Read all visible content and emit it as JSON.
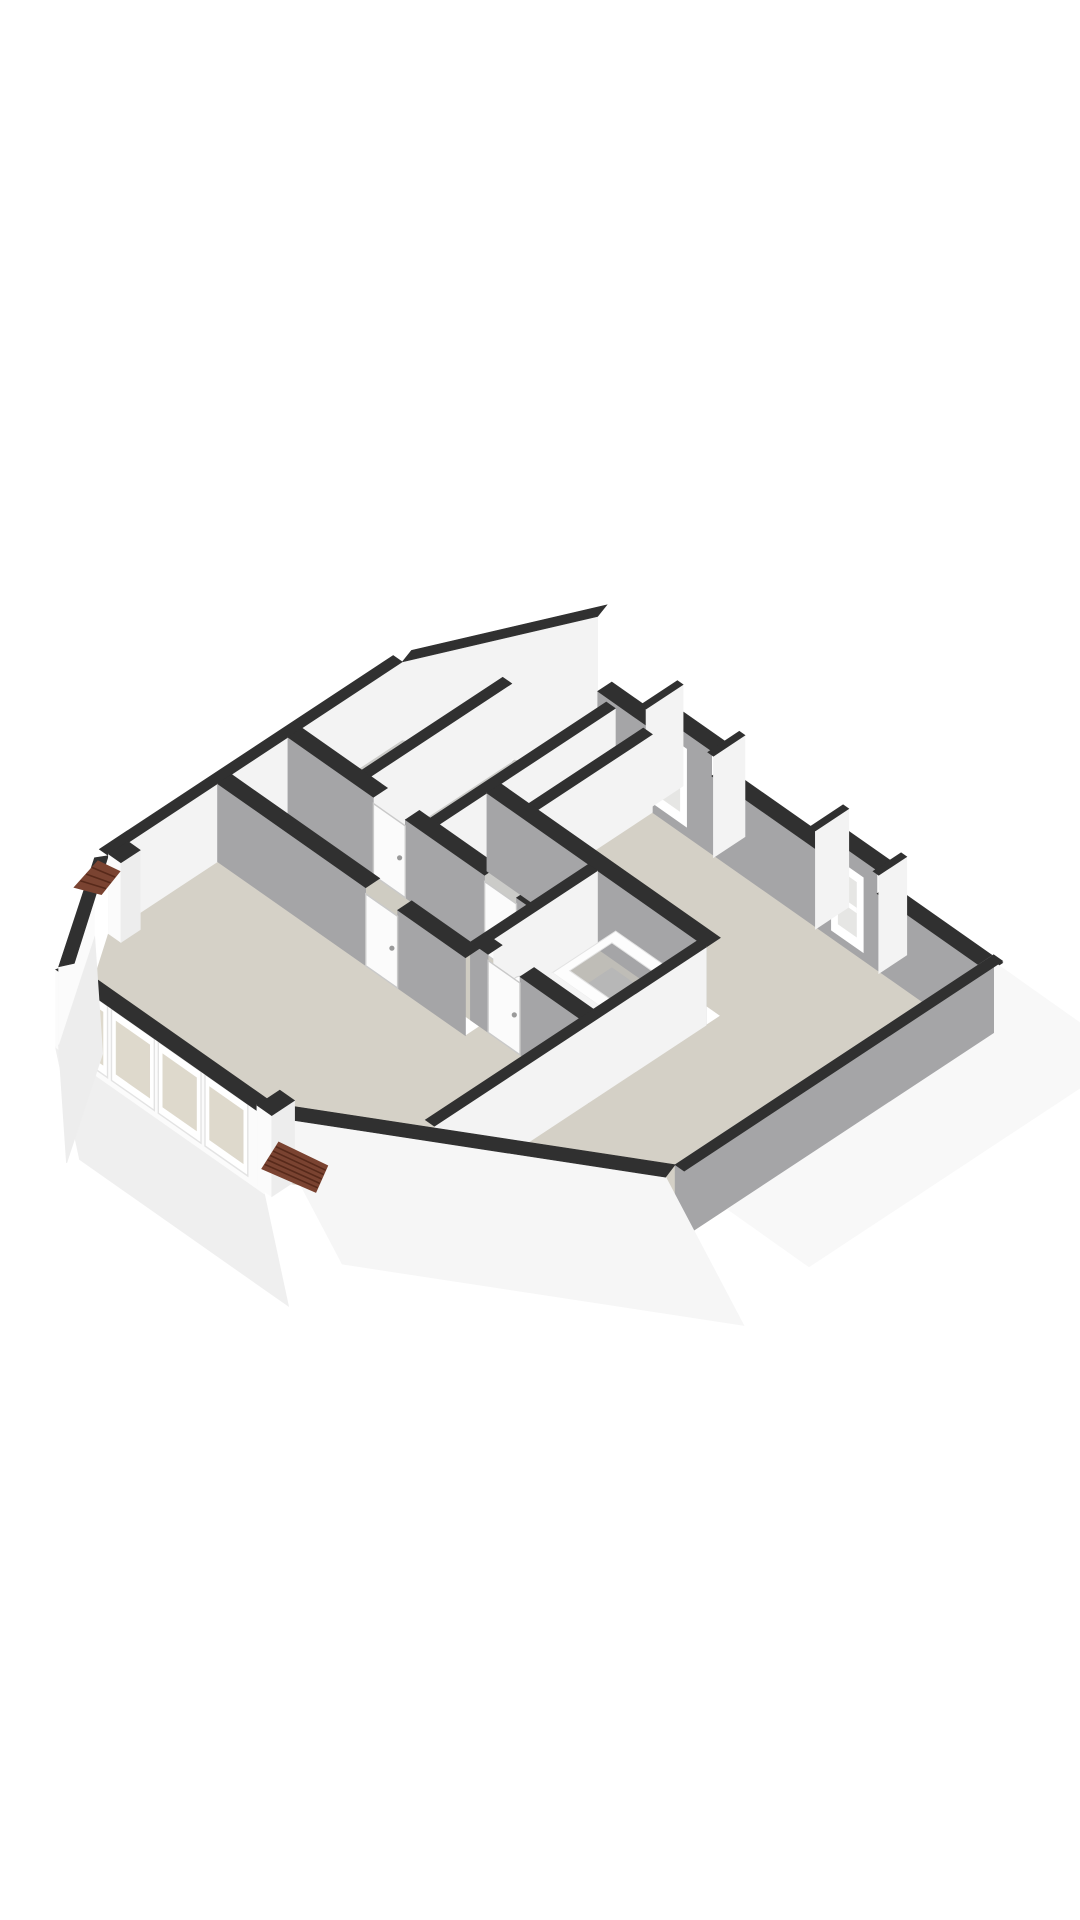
{
  "page": {
    "background": "#ffffff",
    "label": "3d-floorplan-render"
  },
  "scene": {
    "projection": {
      "ox": 478,
      "oy": 690,
      "ux": 57,
      "uy": 40,
      "vx": -88,
      "vy": 58,
      "hz": 78
    },
    "palette": {
      "cap": "#303030",
      "grayFace": "#a5a5a7",
      "grayFace2": "#9c9c9e",
      "white": "#f3f3f3",
      "whiteBright": "#fbfbfb",
      "frame": "#ffffff",
      "floorLiving": "#d5d1c7",
      "floorBed": "#d4d0c6",
      "floorHall": "#cfccc2",
      "floorSmall": "#cbcbc8",
      "floorBath": "#bfbdb7",
      "glassS": "#ded9cc",
      "glassN": "#e6e6e4",
      "roof": "#7a4331",
      "roofLine": "#57291a",
      "skirtS": "#efefef",
      "skirtE": "#f8f8f8",
      "doorFill": "#fbfbfb",
      "doorStroke": "#c9c9c9",
      "tubFloor": "#b7b7b7",
      "tubStroke": "#e3e3e3"
    },
    "elements": [
      {
        "name": "floor-room-topleft-a",
        "type": "floor",
        "pts": [
          [
            0,
            0.86
          ],
          [
            1.05,
            0.43
          ],
          [
            1.05,
            2.0
          ],
          [
            0,
            2.0
          ]
        ],
        "fill": "floorSmall"
      },
      {
        "name": "floor-room-topleft-b",
        "type": "floor",
        "pts": [
          [
            1.21,
            0.36
          ],
          [
            2.41,
            0
          ],
          [
            2.41,
            2.0
          ],
          [
            1.21,
            2.0
          ]
        ],
        "fill": "floorSmall"
      },
      {
        "name": "floor-nook",
        "type": "floor",
        "pts": [
          [
            2.41,
            0
          ],
          [
            2.9,
            0
          ],
          [
            2.9,
            1.3
          ],
          [
            2.41,
            1.3
          ]
        ],
        "fill": "floorBed"
      },
      {
        "name": "floor-bedroom",
        "type": "floor",
        "pts": [
          [
            3.06,
            0
          ],
          [
            8.8,
            0
          ],
          [
            8.8,
            3.46
          ],
          [
            6.26,
            4.55
          ],
          [
            6.26,
            1.3
          ],
          [
            3.06,
            1.3
          ]
        ],
        "fill": "floorBed"
      },
      {
        "name": "floor-closet",
        "type": "floor",
        "pts": [
          [
            2.41,
            1.46
          ],
          [
            4.19,
            1.46
          ],
          [
            4.19,
            2.0
          ],
          [
            2.41,
            2.0
          ]
        ],
        "fill": "floorSmall"
      },
      {
        "name": "floor-hallway",
        "type": "floor",
        "pts": [
          [
            0,
            2.16
          ],
          [
            4.35,
            2.16
          ],
          [
            4.35,
            2.8
          ],
          [
            0,
            2.8
          ]
        ],
        "fill": "floorHall"
      },
      {
        "name": "floor-bathroom",
        "type": "floor",
        "pts": [
          [
            4.35,
            1.46
          ],
          [
            6.1,
            1.46
          ],
          [
            6.1,
            2.64
          ],
          [
            4.35,
            2.64
          ]
        ],
        "fill": "floorBath"
      },
      {
        "name": "floor-livingroom",
        "type": "floor",
        "pts": [
          [
            0,
            2.96
          ],
          [
            4.35,
            2.96
          ],
          [
            4.35,
            2.8
          ],
          [
            6.1,
            2.8
          ],
          [
            6.1,
            4.62
          ],
          [
            4.6,
            5.3
          ],
          [
            1.1,
            5.3
          ],
          [
            0,
            4.2
          ]
        ],
        "fill": "floorLiving"
      },
      {
        "name": "gable-wall-face",
        "type": "poly3",
        "pts": [
          [
            0,
            0.86,
            0
          ],
          [
            2.1,
            0,
            0
          ],
          [
            2.1,
            0,
            2.02
          ],
          [
            0,
            0.86,
            1.0
          ]
        ],
        "fill": "white"
      },
      {
        "name": "gable-wall-cap",
        "type": "poly3",
        "pts": [
          [
            2.1,
            0,
            2.02
          ],
          [
            0,
            0.86,
            1.0
          ],
          [
            -0.07,
            0.71,
            1.0
          ],
          [
            2.03,
            -0.15,
            2.02
          ]
        ],
        "fill": "cap"
      },
      {
        "name": "north-wall-1",
        "type": "uwall",
        "x1": 2.1,
        "x2": 2.95,
        "y": -0.16,
        "h": 1.06,
        "face": "grayFace"
      },
      {
        "name": "north-wall-dormer-1",
        "type": "uwall",
        "x1": 2.95,
        "x2": 4.1,
        "y": -0.16,
        "h": 1.32,
        "face": "grayFace",
        "wins": [
          {
            "u1": 3.02,
            "u2": 3.66,
            "z1": 0.12,
            "z2": 1.12,
            "fill": "frame"
          },
          {
            "u1": 3.14,
            "u2": 3.54,
            "z1": 0.26,
            "z2": 1.0,
            "fill": "glassN"
          },
          {
            "u1": 3.14,
            "u2": 3.54,
            "z1": 0.6,
            "z2": 0.66,
            "fill": "frame"
          }
        ]
      },
      {
        "name": "north-wall-2",
        "type": "uwall",
        "x1": 4.1,
        "x2": 5.92,
        "y": -0.16,
        "h": 1.0,
        "face": "grayFace"
      },
      {
        "name": "north-wall-dormer-2",
        "type": "uwall",
        "x1": 5.92,
        "x2": 7.0,
        "y": -0.16,
        "h": 1.28,
        "face": "grayFace",
        "wins": [
          {
            "u1": 6.2,
            "u2": 6.76,
            "z1": 0.1,
            "z2": 1.06,
            "fill": "frame"
          },
          {
            "u1": 6.32,
            "u2": 6.64,
            "z1": 0.24,
            "z2": 0.94,
            "fill": "glassN"
          },
          {
            "u1": 6.32,
            "u2": 6.64,
            "z1": 0.55,
            "z2": 0.61,
            "fill": "frame"
          }
        ]
      },
      {
        "name": "north-wall-3",
        "type": "uwall",
        "x1": 7.0,
        "x2": 8.96,
        "y": -0.16,
        "h": 0.98,
        "face": "grayFace"
      },
      {
        "name": "dormer-1-cheek-left",
        "type": "vwall",
        "x": 2.88,
        "t": 0.1,
        "y1": -0.4,
        "y2": 0.02,
        "h": 1.3,
        "face": "white"
      },
      {
        "name": "dormer-1-cheek-right",
        "type": "vwall",
        "x": 4.06,
        "t": 0.1,
        "y1": -0.34,
        "y2": 0.02,
        "h": 1.3,
        "face": "white"
      },
      {
        "name": "dormer-2-cheek-left",
        "type": "vwall",
        "x": 5.85,
        "t": 0.1,
        "y1": -0.36,
        "y2": 0.02,
        "h": 1.26,
        "face": "white"
      },
      {
        "name": "dormer-2-cheek-right",
        "type": "vwall",
        "x": 6.96,
        "t": 0.1,
        "y1": -0.3,
        "y2": 0.02,
        "h": 1.26,
        "face": "white"
      },
      {
        "name": "west-wall",
        "type": "vwall",
        "x": -0.16,
        "t": 0.16,
        "y1": 0.86,
        "y2": 4.2,
        "h": 1.0,
        "face": "white"
      },
      {
        "name": "closet-block-east-wall",
        "type": "vwall",
        "x": 2.25,
        "t": 0.16,
        "y1": 0,
        "y2": 2.0,
        "h": 1,
        "face": "white"
      },
      {
        "name": "closet-block-divider-wall",
        "type": "vwall",
        "x": 1.05,
        "t": 0.16,
        "y1": 0.4,
        "y2": 2.0,
        "h": 1,
        "face": "white"
      },
      {
        "name": "closet-block-south-wall",
        "type": "uwall",
        "x1": 0,
        "x2": 4.35,
        "y": 2.0,
        "h": 1,
        "face": "grayFace",
        "gaps": [
          [
            1.5,
            2.06
          ],
          [
            3.45,
            4.01
          ]
        ]
      },
      {
        "name": "door-topleft-room",
        "type": "frect",
        "plane": "y",
        "at": 2.16,
        "u1": 1.5,
        "u2": 2.06,
        "z1": 0,
        "z2": 0.92,
        "fill": "doorFill",
        "stroke": "doorStroke",
        "handle": true
      },
      {
        "name": "door-closet",
        "type": "frect",
        "plane": "y",
        "at": 2.16,
        "u1": 3.45,
        "u2": 4.01,
        "z1": 0,
        "z2": 0.92,
        "fill": "doorFill",
        "stroke": "doorStroke",
        "handle": true
      },
      {
        "name": "nook-east-wall",
        "type": "vwall",
        "x": 2.9,
        "t": 0.16,
        "y1": 0,
        "y2": 1.3,
        "h": 1,
        "face": "white"
      },
      {
        "name": "bedroom-south-wall",
        "type": "uwall",
        "x1": 2.41,
        "x2": 6.26,
        "y": 1.3,
        "h": 1,
        "face": "grayFace"
      },
      {
        "name": "bathroom-west-wall",
        "type": "vwall",
        "x": 4.19,
        "t": 0.16,
        "y1": 1.46,
        "y2": 2.64,
        "h": 1,
        "face": "white"
      },
      {
        "name": "bathtub",
        "type": "ring",
        "outer": [
          4.7,
          1.48,
          6.0,
          2.2
        ],
        "inner": [
          4.82,
          1.6,
          5.88,
          2.08
        ],
        "ztop": 0.42,
        "zfloor": 0.1
      },
      {
        "name": "toilet-bowl",
        "type": "ellipse",
        "c": [
          4.52,
          2.38,
          0.3
        ],
        "rx": 14,
        "ry": 9,
        "fill": "#fdfdfd",
        "stroke": "#d8d8d8"
      },
      {
        "name": "toilet-tank",
        "type": "box",
        "x1": 4.38,
        "y1": 2.48,
        "x2": 4.64,
        "y2": 2.62,
        "h": 0.4,
        "top": "#f6f6f6",
        "south": "#ececec",
        "east": "#e6e6e6"
      },
      {
        "name": "bathroom-south-wall",
        "type": "uwall",
        "x1": 4.19,
        "x2": 6.26,
        "y": 2.64,
        "h": 1,
        "face": "grayFace",
        "gaps": [
          [
            4.5,
            5.06
          ]
        ]
      },
      {
        "name": "door-bathroom",
        "type": "frect",
        "plane": "y",
        "at": 2.8,
        "u1": 4.5,
        "u2": 5.06,
        "z1": 0,
        "z2": 0.92,
        "fill": "doorFill",
        "stroke": "doorStroke",
        "handle": true
      },
      {
        "name": "bathroom-east-wall",
        "type": "vwall",
        "x": 6.1,
        "t": 0.16,
        "y1": 1.46,
        "y2": 4.55,
        "h": 1,
        "face": "white"
      },
      {
        "name": "livingroom-north-wall",
        "type": "uwall",
        "x1": 0,
        "x2": 4.35,
        "y": 2.8,
        "h": 1,
        "face": "grayFace",
        "gaps": [
          [
            2.6,
            3.16
          ]
        ]
      },
      {
        "name": "door-livingroom",
        "type": "frect",
        "plane": "y",
        "at": 2.96,
        "u1": 2.6,
        "u2": 3.16,
        "z1": 0,
        "z2": 0.92,
        "fill": "doorFill",
        "stroke": "doorStroke",
        "handle": true
      },
      {
        "name": "east-skirt",
        "type": "skirt",
        "p1": [
          8.96,
          -0.1,
          1
        ],
        "p2": [
          8.96,
          3.52,
          1
        ],
        "off": [
          130,
          92
        ],
        "fill": "skirtE"
      },
      {
        "name": "east-wall",
        "type": "vwall",
        "x": 8.8,
        "t": 0.16,
        "y1": -0.16,
        "y2": 3.46,
        "h": 1,
        "face": "grayFace",
        "side": -1
      },
      {
        "name": "southeast-skirt",
        "type": "skirt",
        "p1": [
          8.88,
          3.62,
          1
        ],
        "p2": [
          4.68,
          5.46,
          1
        ],
        "off": [
          78,
          148
        ],
        "fill": "#f6f6f6"
      },
      {
        "name": "southeast-chamfer-cap",
        "type": "poly3",
        "pts": [
          [
            8.8,
            3.46,
            1
          ],
          [
            4.6,
            5.3,
            1
          ],
          [
            4.68,
            5.46,
            1
          ],
          [
            8.88,
            3.62,
            1
          ]
        ],
        "fill": "cap"
      },
      {
        "name": "south-skirt",
        "type": "skirt",
        "p1": [
          1.02,
          5.46,
          0
        ],
        "p2": [
          4.68,
          5.46,
          0
        ],
        "off": [
          24,
          112
        ],
        "fill": "skirtS"
      },
      {
        "name": "south-wall-outer-face",
        "type": "frect",
        "plane": "y",
        "at": 5.46,
        "u1": 1.02,
        "u2": 4.68,
        "z1": 0,
        "z2": 1.0,
        "fill": "whiteBright"
      },
      {
        "name": "window-1-frame",
        "type": "frect",
        "plane": "y",
        "at": 5.46,
        "u1": 1.18,
        "u2": 1.93,
        "z1": 0.08,
        "z2": 1.0,
        "fill": "frame",
        "stroke": "#e3e3e3"
      },
      {
        "name": "window-1-glass",
        "type": "frect",
        "plane": "y",
        "at": 5.46,
        "u1": 1.26,
        "u2": 1.85,
        "z1": 0.2,
        "z2": 0.88,
        "fill": "glassS"
      },
      {
        "name": "window-2-frame",
        "type": "frect",
        "plane": "y",
        "at": 5.46,
        "u1": 2.0,
        "u2": 2.75,
        "z1": 0.08,
        "z2": 1.0,
        "fill": "frame",
        "stroke": "#e3e3e3"
      },
      {
        "name": "window-2-glass",
        "type": "frect",
        "plane": "y",
        "at": 5.46,
        "u1": 2.08,
        "u2": 2.67,
        "z1": 0.2,
        "z2": 0.88,
        "fill": "glassS"
      },
      {
        "name": "window-3-frame",
        "type": "frect",
        "plane": "y",
        "at": 5.46,
        "u1": 2.82,
        "u2": 3.57,
        "z1": 0.08,
        "z2": 1.0,
        "fill": "frame",
        "stroke": "#e3e3e3"
      },
      {
        "name": "window-3-glass",
        "type": "frect",
        "plane": "y",
        "at": 5.46,
        "u1": 2.9,
        "u2": 3.49,
        "z1": 0.2,
        "z2": 0.88,
        "fill": "glassS"
      },
      {
        "name": "window-4-frame",
        "type": "frect",
        "plane": "y",
        "at": 5.46,
        "u1": 3.64,
        "u2": 4.39,
        "z1": 0.08,
        "z2": 1.0,
        "fill": "frame",
        "stroke": "#e3e3e3"
      },
      {
        "name": "window-4-glass",
        "type": "frect",
        "plane": "y",
        "at": 5.46,
        "u1": 3.72,
        "u2": 4.31,
        "z1": 0.2,
        "z2": 0.88,
        "fill": "glassS"
      },
      {
        "name": "south-wall-cap",
        "type": "poly3",
        "pts": [
          [
            1.1,
            5.3,
            1
          ],
          [
            4.6,
            5.3,
            1
          ],
          [
            4.68,
            5.46,
            1
          ],
          [
            1.02,
            5.46,
            1
          ]
        ],
        "fill": "cap"
      },
      {
        "name": "southwest-skirt",
        "type": "skirt",
        "p1": [
          -0.09,
          4.3,
          0
        ],
        "p2": [
          1.01,
          5.42,
          0
        ],
        "off": [
          8,
          118
        ],
        "fill": "#ededed"
      },
      {
        "name": "southwest-chamfer-face",
        "type": "poly3",
        "pts": [
          [
            -0.09,
            4.3,
            0
          ],
          [
            1.01,
            5.42,
            0
          ],
          [
            1.01,
            5.42,
            1
          ],
          [
            -0.09,
            4.3,
            1
          ]
        ],
        "fill": "whiteBright"
      },
      {
        "name": "southwest-chamfer-cap",
        "type": "poly3",
        "pts": [
          [
            0,
            4.2,
            1
          ],
          [
            1.1,
            5.3,
            1
          ],
          [
            1.01,
            5.42,
            1
          ],
          [
            -0.09,
            4.3,
            1
          ]
        ],
        "fill": "cap"
      },
      {
        "name": "south-pillar",
        "type": "box",
        "x1": 4.52,
        "y1": 5.18,
        "x2": 4.78,
        "y2": 5.44,
        "h": 1.04,
        "top": "cap",
        "south": "whiteBright",
        "east": "#ededed"
      },
      {
        "name": "west-pillar",
        "type": "box",
        "x1": 0.0,
        "y1": 3.98,
        "x2": 0.22,
        "y2": 4.2,
        "h": 1.02,
        "top": "cap",
        "south": "whiteBright",
        "east": "#ededed"
      },
      {
        "name": "roof-tiles-southeast",
        "type": "patch",
        "pts": [
          [
            4.84,
            5.4
          ],
          [
            5.56,
            5.31
          ],
          [
            5.8,
            5.6
          ],
          [
            5.04,
            5.72
          ]
        ],
        "z": 0.7,
        "fill": "roof",
        "stripes": 6
      },
      {
        "name": "roof-tiles-west",
        "type": "patch",
        "pts": [
          [
            -0.12,
            4.24
          ],
          [
            0.2,
            4.2
          ],
          [
            0.34,
            4.5
          ],
          [
            0.02,
            4.6
          ]
        ],
        "z": 0.9,
        "fill": "roof",
        "stripes": 4
      }
    ]
  }
}
